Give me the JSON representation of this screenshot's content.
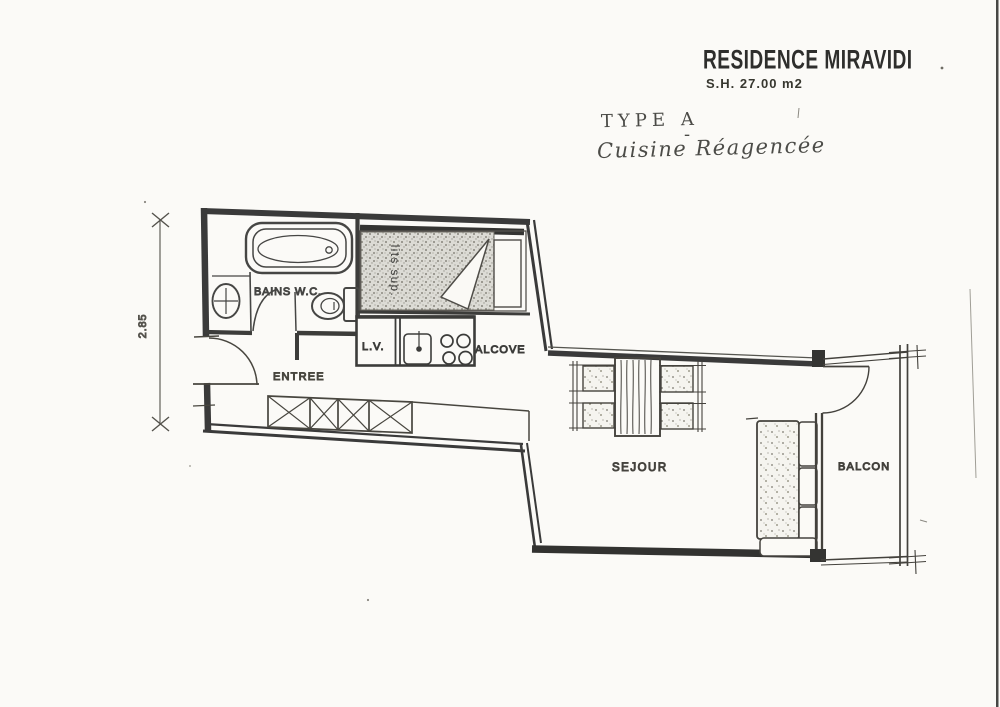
{
  "title_block": {
    "residence": "RESIDENCE MIRAVIDI",
    "surface": "S.H.  27.00 m2"
  },
  "annotations": {
    "type_label": "TYPE A",
    "type_dash": "-",
    "handwritten_note": "Cuisine Réagencée"
  },
  "room_labels": {
    "bains_wc": "BAINS W.C.",
    "entree": "ENTREE",
    "lave_vaisselle": "L.V.",
    "alcove": "ALCOVE",
    "sejour": "SEJOUR",
    "balcon": "BALCON",
    "lits_sup": "lits sup."
  },
  "dimensions": {
    "left_wall": "2.85"
  },
  "colors": {
    "paper": "#fbfaf7",
    "ink": "#3a3a3a",
    "ink_light": "#6b6b66"
  }
}
